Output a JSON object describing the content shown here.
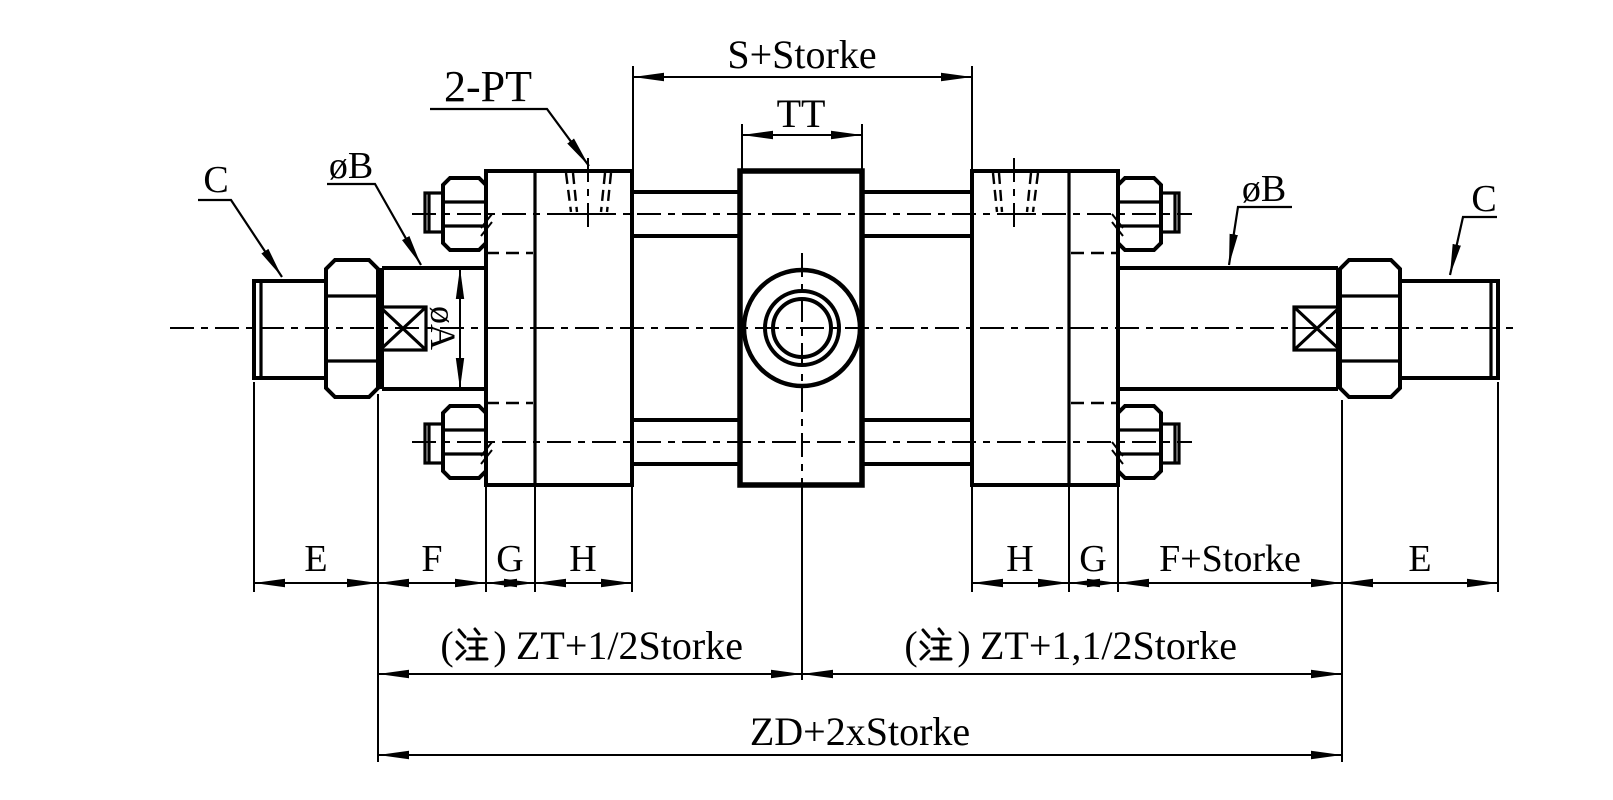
{
  "drawing": {
    "kind": "engineering-dimension-drawing",
    "subject": "double-rod hydraulic cylinder with center trunnion mount",
    "colors": {
      "line": "#000000",
      "background": "#ffffff"
    },
    "labels": {
      "s_plus_stroke": "S+Storke",
      "trunnion_width": "TT",
      "ports": "2-PT",
      "rod_thread_left": "C",
      "rod_thread_right": "C",
      "rod_dia_left": "øB",
      "rod_dia_right": "øB",
      "piston_rod_dia": "øA",
      "row_left": [
        "E",
        "F",
        "G",
        "H"
      ],
      "row_right": [
        "H",
        "G",
        "F+Storke",
        "E"
      ],
      "paren_open": "(",
      "note_char": "注",
      "paren_close": ")",
      "zt_left": "ZT+1/2Storke",
      "zt_right": "ZT+1,1/2Storke",
      "zt_left_full": "(注) ZT+1/2Storke",
      "zt_right_full": "(注) ZT+1,1/2Storke",
      "zd_total": "ZD+2xStorke"
    }
  }
}
